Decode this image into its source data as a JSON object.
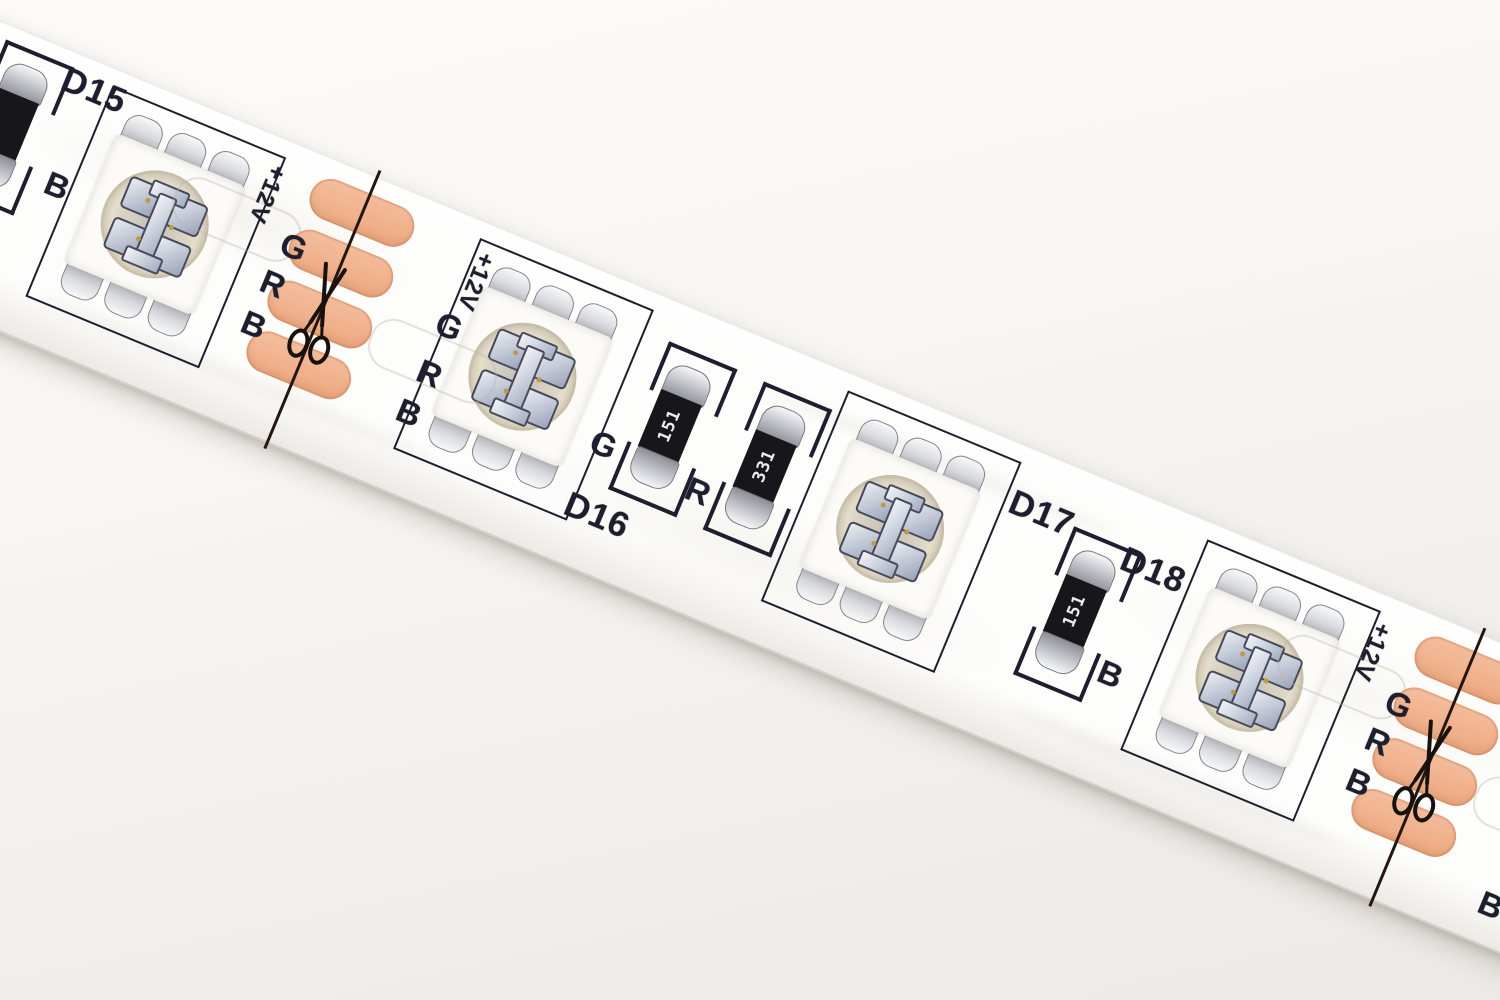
{
  "scene": {
    "subject": "Close-up photograph of a flexible 12V RGB LED strip on a white background",
    "strip_angle_deg": 22.5
  },
  "strip": {
    "pin_labels": {
      "power": "+12V",
      "green": "G",
      "red": "R",
      "blue": "B"
    },
    "leds": [
      {
        "designator": "D15"
      },
      {
        "designator": "D16"
      },
      {
        "designator": "D17"
      },
      {
        "designator": "D18"
      }
    ],
    "resistors": [
      {
        "value": "151",
        "channel": "G"
      },
      {
        "value": "331",
        "channel": "R"
      },
      {
        "value": "151",
        "channel": "B"
      }
    ],
    "partial_resistor": {
      "channel": "B"
    },
    "icons": {
      "cut_marker": "scissors-icon"
    },
    "colors": {
      "pcb": "#fdfdfb",
      "silkscreen": "#1e1f2e",
      "copper_pad": "#f0ac85",
      "resistor_body": "#17171b",
      "led_lens": "#ece5d0"
    }
  }
}
